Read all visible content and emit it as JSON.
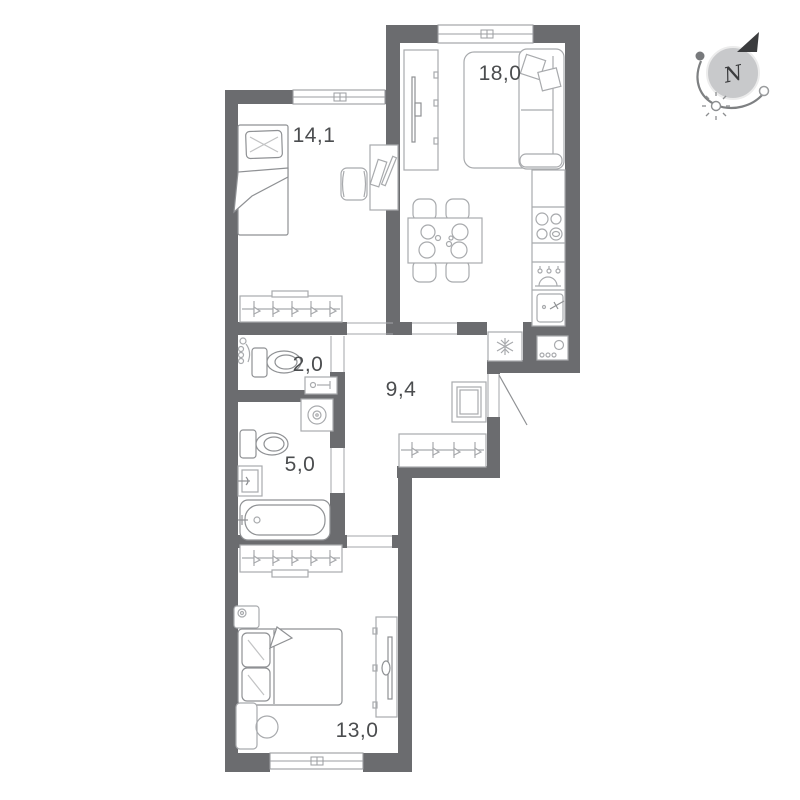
{
  "page": {
    "type": "apartment-floor-plan"
  },
  "rooms": [
    {
      "name": "living-kitchen",
      "label": "18,0"
    },
    {
      "name": "bedroom",
      "label": "14,1"
    },
    {
      "name": "wc",
      "label": "2,0"
    },
    {
      "name": "hallway",
      "label": "9,4"
    },
    {
      "name": "bathroom",
      "label": "5,0"
    },
    {
      "name": "bedroom-2",
      "label": "13,0"
    }
  ],
  "compass": {
    "label": "N"
  },
  "fixtures": [
    "single-bed",
    "pillow",
    "blanket-fold",
    "desk",
    "desk-chair",
    "wardrobe-with-hooks",
    "sofa",
    "sofa-pillows",
    "rug",
    "tv-unit",
    "tv",
    "dining-table",
    "dining-chairs",
    "plates",
    "kitchen-counter",
    "stove-burners",
    "dishwasher-drops",
    "kitchen-sink",
    "fridge-snowflake",
    "washing-machine",
    "toilet",
    "hand-sink",
    "towel-rail",
    "drum-washer",
    "bathroom-sink",
    "bathtub",
    "mirror-cabinet",
    "nightstand-lamp",
    "double-bed",
    "stool",
    "console",
    "window",
    "entrance-door-swing",
    "compass-north-arrow",
    "compass-sun"
  ],
  "colors": {
    "wall": "#6b6c6f",
    "furniture": "#a8aaad",
    "furniture_dark": "#8f9194",
    "label": "#4b4d4f",
    "background": "#ffffff",
    "compass_fill": "#c8c9cb",
    "compass_dark": "#3b3c3e",
    "compass_stroke": "#7e8082"
  }
}
